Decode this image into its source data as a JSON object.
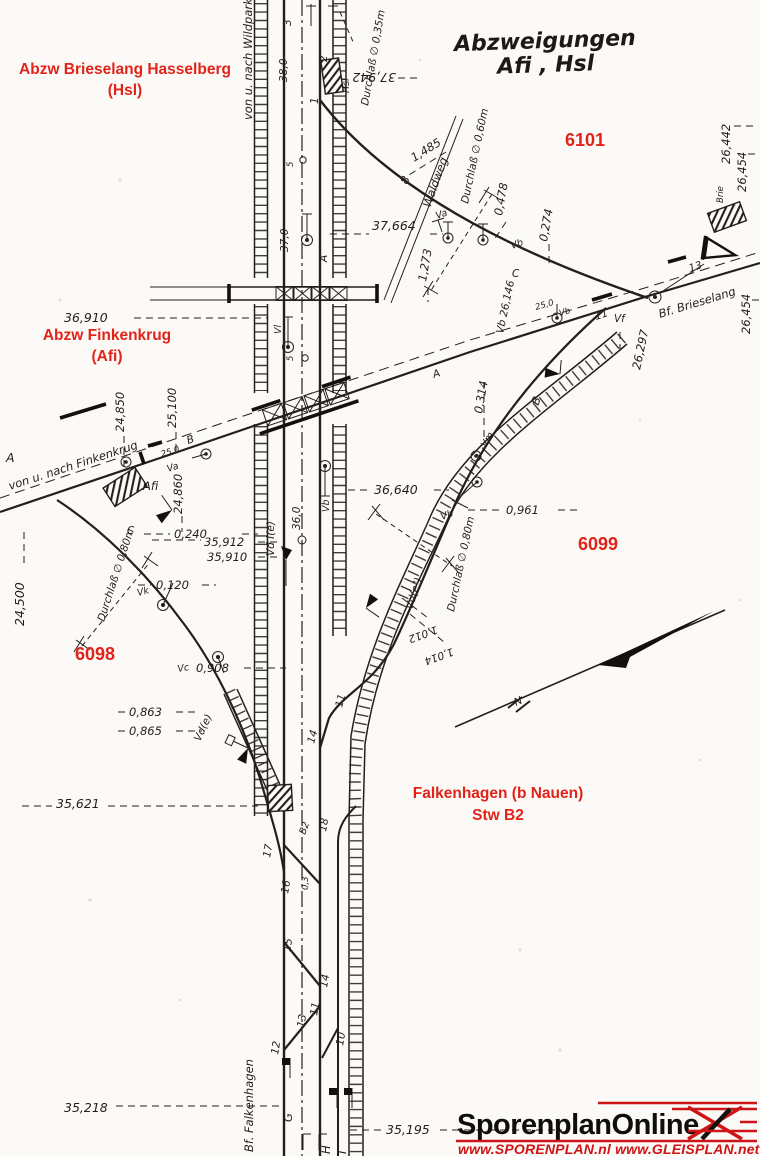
{
  "colors": {
    "paper": "#fbfaf6",
    "ink": "#23201b",
    "red": "#e2231a",
    "logo_red": "#cf1417"
  },
  "title": {
    "line1": "Abzweigungen",
    "line2": "Afi , Hsl"
  },
  "red_labels": {
    "hsl_line1": "Abzw Brieselang Hasselberg",
    "hsl_line2": "(Hsl)",
    "afi_line1": "Abzw Finkenkrug",
    "afi_line2": "(Afi)",
    "n6101": "6101",
    "n6099": "6099",
    "n6098": "6098",
    "falk_line1": "Falkenhagen (b Nauen)",
    "falk_line2": "Stw B2"
  },
  "ann": {
    "wildpark": "von u. nach Wildpark",
    "finkenkrug": "von u. nach Finkenkrug",
    "bf_brieselang": "Bf. Brieselang",
    "bf_falkenhagen": "Bf. Falkenhagen",
    "hsl_box": "Hsl",
    "afi_box": "Afi",
    "brie_box": "Brie",
    "b2_box": "B2",
    "d035": "Durchlaß ∅ 0,35m",
    "d060": "Durchlaß ∅ 0,60m",
    "d080a": "Durchlaß ∅ 0,80m",
    "d080b": "Durchlaß ∅ 0,80m",
    "waldweg": "Waldweg",
    "km37942": "37,942",
    "km38_0": "38,0",
    "km37664": "37,664",
    "km37_0": "37,0",
    "km36910": "36,910",
    "km36640": "36,640",
    "km36_0": "36,0",
    "km35912": "35,912",
    "km35910": "35,910",
    "km35621": "35,621",
    "km35218": "35,218",
    "km35195": "35,195",
    "km26442": "26,442",
    "km26454a": "26,454",
    "km26454b": "26,454",
    "km26297": "26,297",
    "vb26146": "Vb  26,146",
    "km24850": "24,850",
    "km25100": "25,100",
    "km24860": "24,860",
    "km24500": "24,500",
    "d1485": "1,485",
    "d1273": "1,273",
    "d0478": "0,478",
    "d0274": "0,274",
    "d0314": "0,314",
    "d0961": "0,961",
    "d0240": "0,240",
    "d0120": "0,120",
    "d0908": "0,908",
    "d0863": "0,863",
    "d0865": "0,865",
    "d1012": "1,012",
    "d1014": "1,014",
    "sw1": "1",
    "sw2": "2",
    "sw3": "3",
    "sw8": "8",
    "sw11a": "11",
    "sw13a": "13",
    "sw11b": "11",
    "sw14b": "14",
    "sw17": "17",
    "sw18": "18",
    "sw16": "16",
    "sw15": "15",
    "sw14": "14",
    "sw13": "13",
    "sw12": "12",
    "sw11": "11",
    "sw10": "10",
    "g25a": "25,0",
    "g25b": "25,0",
    "g0_3": "0,3",
    "p5a": "5",
    "p5b": "5",
    "va1": "Va",
    "va2": "Va",
    "vb1": "Vb",
    "vb2": "Vb",
    "vb3": "Vb",
    "vb4": "Vb",
    "vf": "Vf",
    "vm": "Vm",
    "vk": "Vk",
    "vc": "Vc",
    "vl": "Vl",
    "vd1": "Vd I(e)",
    "vd2": "Vd(e²)",
    "vde": "Vd(e)",
    "trA1": "A",
    "trA2": "A",
    "trA3": "A",
    "trB1": "B",
    "trB2": "B",
    "trC1": "C",
    "trC2": "C",
    "trG": "G",
    "trH": "H",
    "trI": "I",
    "north": "N"
  },
  "logo": {
    "name": "SporenplanOnline",
    "urls": "www.SPORENPLAN.nl  www.GLEISPLAN.net"
  }
}
